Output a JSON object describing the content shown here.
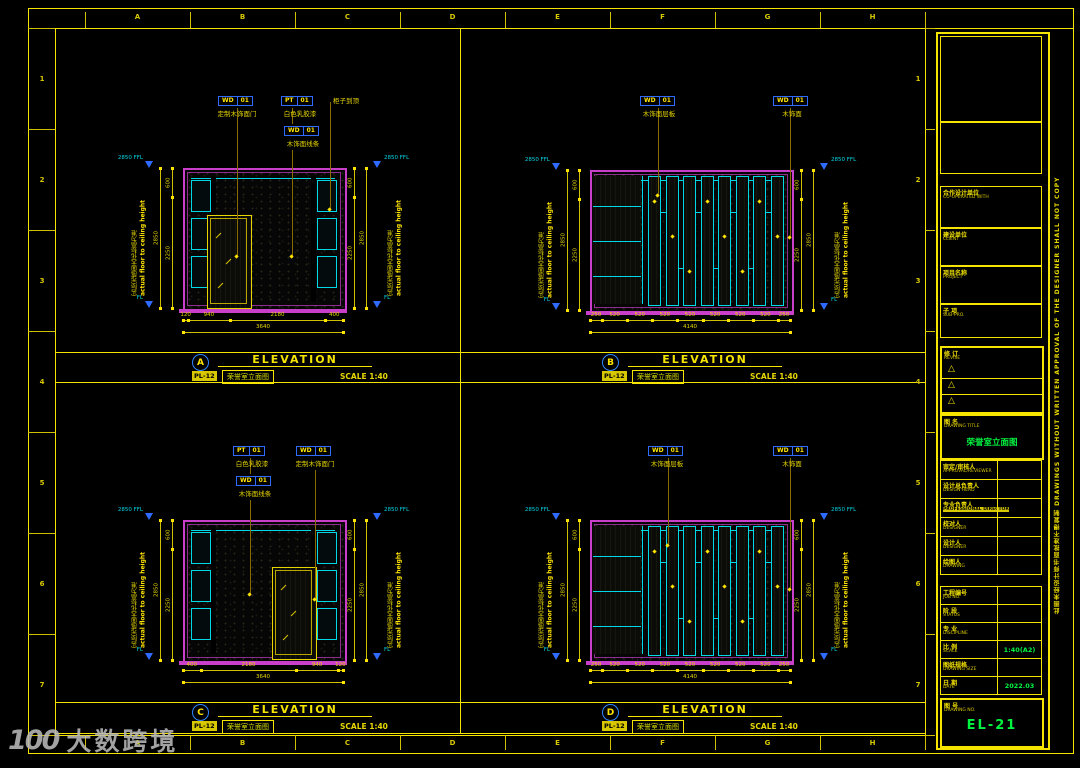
{
  "sheet": {
    "grid_letters": [
      "A",
      "B",
      "C",
      "D",
      "E",
      "F",
      "G",
      "H"
    ],
    "grid_numbers": [
      "1",
      "2",
      "3",
      "4",
      "5",
      "6",
      "7"
    ]
  },
  "watermark": {
    "logo": "100",
    "text": "大数跨境"
  },
  "colors": {
    "background": "#000000",
    "frame_yellow": "#f5e400",
    "dim_yellow": "#cfc000",
    "leader_olive": "#8a6b00",
    "magenta": "#c93fc9",
    "cyan": "#00d8e8",
    "tag_blue": "#2f6bff",
    "level_blue": "#2f6bff",
    "value_green": "#00f541"
  },
  "elevations": [
    {
      "letter": "A",
      "ref": "PL-12",
      "title": "ELEVATION",
      "subtitle": "荣誉室立面图",
      "scale": "SCALE 1:40",
      "labels": [
        {
          "code": "WD",
          "num": "01",
          "text": "定制木饰面门"
        },
        {
          "code": "PT",
          "num": "01",
          "text": "白色乳胶漆"
        },
        {
          "code": "WD",
          "num": "01",
          "text": "木饰面线条"
        },
        {
          "code": "",
          "num": "",
          "text": "柜子到顶"
        }
      ],
      "levels": {
        "top": "2850 FFL",
        "bottom": "FL"
      },
      "note_cn": "实际完成面天花标高为准",
      "note_en": "actual floor to ceiling height",
      "dims_bottom": {
        "segments": [
          "120",
          "940",
          "2180",
          "400"
        ],
        "total": "3640"
      },
      "dims_side": {
        "segments": [
          "600",
          "2250"
        ],
        "total": "2850"
      }
    },
    {
      "letter": "B",
      "ref": "PL-12",
      "title": "ELEVATION",
      "subtitle": "荣誉室立面图",
      "scale": "SCALE 1:40",
      "labels": [
        {
          "code": "WD",
          "num": "01",
          "text": "木饰面层板"
        },
        {
          "code": "WD",
          "num": "01",
          "text": "木饰面"
        }
      ],
      "levels": {
        "top": "2850 FFL",
        "bottom": "FL"
      },
      "note_cn": "实际完成面天花标高为准",
      "note_en": "actual floor to ceiling height",
      "dims_bottom": {
        "segments": [
          "250",
          "520",
          "520",
          "520",
          "520",
          "520",
          "520",
          "520",
          "250"
        ],
        "total": "4140"
      },
      "dims_side": {
        "segments": [
          "600",
          "2250"
        ],
        "total": "2850"
      }
    },
    {
      "letter": "C",
      "ref": "PL-12",
      "title": "ELEVATION",
      "subtitle": "荣誉室立面图",
      "scale": "SCALE 1:40",
      "labels": [
        {
          "code": "PT",
          "num": "01",
          "text": "白色乳胶漆"
        },
        {
          "code": "WD",
          "num": "01",
          "text": "木饰面线条"
        },
        {
          "code": "WD",
          "num": "01",
          "text": "定制木饰面门"
        }
      ],
      "levels": {
        "top": "2850 FFL",
        "bottom": "FL"
      },
      "note_cn": "实际完成面天花标高为准",
      "note_en": "actual floor to ceiling height",
      "dims_bottom": {
        "segments": [
          "400",
          "2180",
          "940",
          "120"
        ],
        "total": "3640"
      },
      "dims_side": {
        "segments": [
          "600",
          "2250"
        ],
        "total": "2850"
      }
    },
    {
      "letter": "D",
      "ref": "PL-12",
      "title": "ELEVATION",
      "subtitle": "荣誉室立面图",
      "scale": "SCALE 1:40",
      "labels": [
        {
          "code": "WD",
          "num": "01",
          "text": "木饰面层板"
        },
        {
          "code": "WD",
          "num": "01",
          "text": "木饰面"
        }
      ],
      "levels": {
        "top": "2850 FFL",
        "bottom": "FL"
      },
      "note_cn": "实际完成面天花标高为准",
      "note_en": "actual floor to ceiling height",
      "dims_bottom": {
        "segments": [
          "250",
          "520",
          "520",
          "520",
          "520",
          "520",
          "520",
          "520",
          "250"
        ],
        "total": "4140"
      },
      "dims_side": {
        "segments": [
          "600",
          "2250"
        ],
        "total": "2850"
      }
    }
  ],
  "titleblock": {
    "sections": [
      {
        "cn": "合作设计单位",
        "en": "CO-OPERATED WITH"
      },
      {
        "cn": "建设单位",
        "en": "CLIENT"
      },
      {
        "cn": "项目名称",
        "en": "PROJECT"
      },
      {
        "cn": "子 项",
        "en": "SUB-PRO."
      }
    ],
    "revise": {
      "cn": "修 订",
      "en": "REVISE",
      "marks": [
        "△",
        "△",
        "△"
      ]
    },
    "drawing_title": {
      "cn": "图 名",
      "en": "DRAWING TITLE",
      "value": "荣誉室立面图"
    },
    "people": [
      {
        "cn": "审定/审核人",
        "en": "APPROVAL/REVIEWER",
        "highlight": false
      },
      {
        "cn": "设计总负责人",
        "en": "DESIGN HEAD",
        "highlight": false
      },
      {
        "cn": "专业负责人",
        "en": "PROFESSIONAL DIRECTOR",
        "highlight": true
      },
      {
        "cn": "校对人",
        "en": "DESIGNER",
        "highlight": false
      },
      {
        "cn": "设计人",
        "en": "DESIGNER",
        "highlight": false
      },
      {
        "cn": "绘图人",
        "en": "DRAWING",
        "highlight": false
      }
    ],
    "meta": [
      {
        "cn": "工程编号",
        "en": "JOB NO.",
        "value": ""
      },
      {
        "cn": "阶 段",
        "en": "STATUS",
        "value": ""
      },
      {
        "cn": "专 业",
        "en": "DISCIPLINE",
        "value": ""
      },
      {
        "cn": "比 例",
        "en": "SCALE",
        "value": "1:40(A2)"
      },
      {
        "cn": "图纸规格",
        "en": "DRAWING SIZE",
        "value": ""
      },
      {
        "cn": "日 期",
        "en": "DATE",
        "value": "2022.03"
      }
    ],
    "drawing_no": {
      "cn": "图 号",
      "en": "DRAWING NO.",
      "value": "EL-21"
    },
    "side_note": "此图未经设计师书面批准不得复制  DRAWINGS WITHOUT WRITTEN APPROVAL OF THE DESIGNER SHALL NOT COPY"
  }
}
